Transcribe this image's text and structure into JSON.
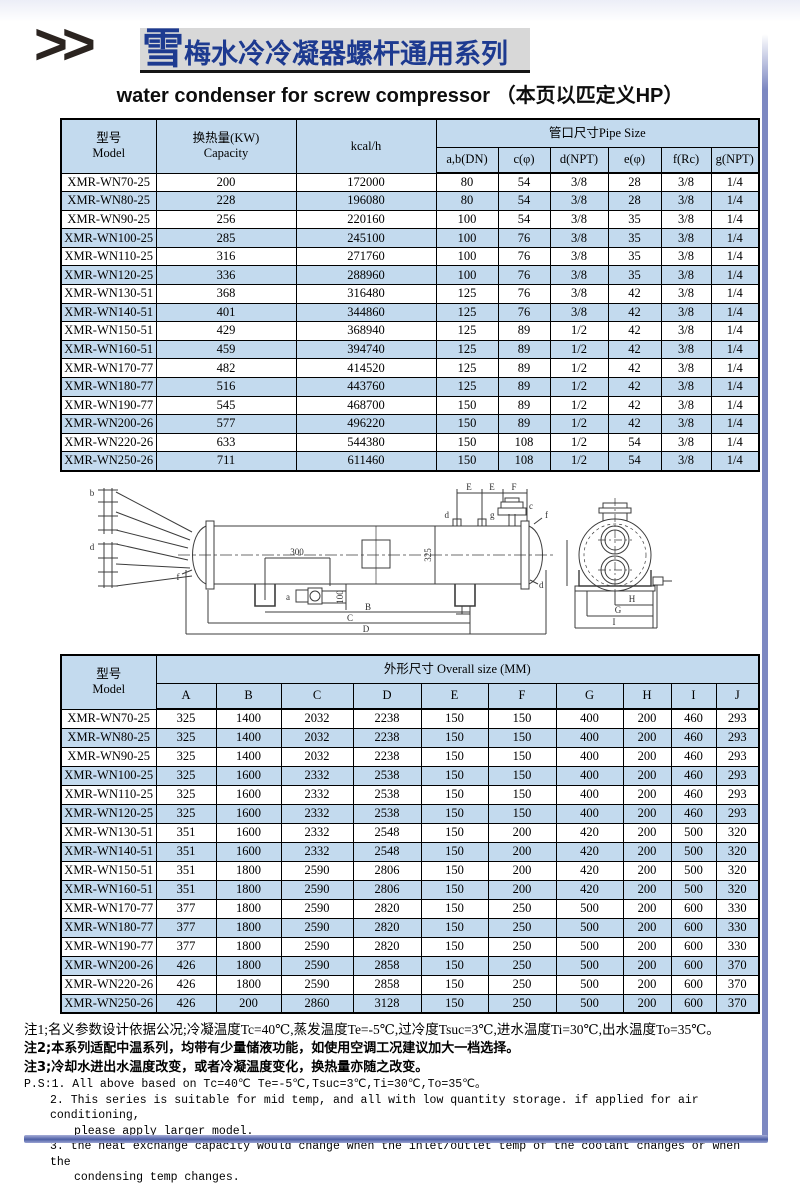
{
  "page": {
    "chevrons": ">>",
    "logo_char": "雪",
    "title_cn": "梅水冷冷凝器螺杆通用系列",
    "subtitle": "water condenser for screw compressor （本页以匹定义HP）"
  },
  "pipe_table": {
    "col_model": "型号",
    "col_model_en": "Model",
    "col_capacity": "换热量(KW)",
    "col_capacity_en": "Capacity",
    "col_kcal": "kcal/h",
    "col_pipe": "管口尺寸Pipe Size",
    "sub_cols": [
      "a,b(DN)",
      "c(φ)",
      "d(NPT)",
      "e(φ)",
      "f(Rc)",
      "g(NPT)"
    ],
    "rows": [
      [
        "XMR-WN70-25",
        "200",
        "172000",
        "80",
        "54",
        "3/8",
        "28",
        "3/8",
        "1/4"
      ],
      [
        "XMR-WN80-25",
        "228",
        "196080",
        "80",
        "54",
        "3/8",
        "28",
        "3/8",
        "1/4"
      ],
      [
        "XMR-WN90-25",
        "256",
        "220160",
        "100",
        "54",
        "3/8",
        "35",
        "3/8",
        "1/4"
      ],
      [
        "XMR-WN100-25",
        "285",
        "245100",
        "100",
        "76",
        "3/8",
        "35",
        "3/8",
        "1/4"
      ],
      [
        "XMR-WN110-25",
        "316",
        "271760",
        "100",
        "76",
        "3/8",
        "35",
        "3/8",
        "1/4"
      ],
      [
        "XMR-WN120-25",
        "336",
        "288960",
        "100",
        "76",
        "3/8",
        "35",
        "3/8",
        "1/4"
      ],
      [
        "XMR-WN130-51",
        "368",
        "316480",
        "125",
        "76",
        "3/8",
        "42",
        "3/8",
        "1/4"
      ],
      [
        "XMR-WN140-51",
        "401",
        "344860",
        "125",
        "76",
        "3/8",
        "42",
        "3/8",
        "1/4"
      ],
      [
        "XMR-WN150-51",
        "429",
        "368940",
        "125",
        "89",
        "1/2",
        "42",
        "3/8",
        "1/4"
      ],
      [
        "XMR-WN160-51",
        "459",
        "394740",
        "125",
        "89",
        "1/2",
        "42",
        "3/8",
        "1/4"
      ],
      [
        "XMR-WN170-77",
        "482",
        "414520",
        "125",
        "89",
        "1/2",
        "42",
        "3/8",
        "1/4"
      ],
      [
        "XMR-WN180-77",
        "516",
        "443760",
        "125",
        "89",
        "1/2",
        "42",
        "3/8",
        "1/4"
      ],
      [
        "XMR-WN190-77",
        "545",
        "468700",
        "150",
        "89",
        "1/2",
        "42",
        "3/8",
        "1/4"
      ],
      [
        "XMR-WN200-26",
        "577",
        "496220",
        "150",
        "89",
        "1/2",
        "42",
        "3/8",
        "1/4"
      ],
      [
        "XMR-WN220-26",
        "633",
        "544380",
        "150",
        "108",
        "1/2",
        "54",
        "3/8",
        "1/4"
      ],
      [
        "XMR-WN250-26",
        "711",
        "611460",
        "150",
        "108",
        "1/2",
        "54",
        "3/8",
        "1/4"
      ]
    ]
  },
  "drawing": {
    "labels": {
      "nozzle_b": "b",
      "nozzle_d_left": "d",
      "nozzle_f_left": "f",
      "valve_a": "a",
      "dim_300": "300",
      "dim_100": "100",
      "dim_325": "325",
      "dim_B": "B",
      "dim_C": "C",
      "dim_D": "D",
      "dim_E1": "E",
      "dim_E2": "E",
      "dim_F": "F",
      "nozzle_d_top": "d",
      "nozzle_g": "g",
      "valve_c": "c",
      "nozzle_f_right": "f",
      "nozzle_d_right": "d",
      "dim_H": "H",
      "dim_G": "G",
      "dim_I": "I"
    }
  },
  "size_table": {
    "col_model": "型号",
    "col_model_en": "Model",
    "col_overall": "外形尺寸 Overall size (MM)",
    "sub_cols": [
      "A",
      "B",
      "C",
      "D",
      "E",
      "F",
      "G",
      "H",
      "I",
      "J"
    ],
    "rows": [
      [
        "XMR-WN70-25",
        "325",
        "1400",
        "2032",
        "2238",
        "150",
        "150",
        "400",
        "200",
        "460",
        "293"
      ],
      [
        "XMR-WN80-25",
        "325",
        "1400",
        "2032",
        "2238",
        "150",
        "150",
        "400",
        "200",
        "460",
        "293"
      ],
      [
        "XMR-WN90-25",
        "325",
        "1400",
        "2032",
        "2238",
        "150",
        "150",
        "400",
        "200",
        "460",
        "293"
      ],
      [
        "XMR-WN100-25",
        "325",
        "1600",
        "2332",
        "2538",
        "150",
        "150",
        "400",
        "200",
        "460",
        "293"
      ],
      [
        "XMR-WN110-25",
        "325",
        "1600",
        "2332",
        "2538",
        "150",
        "150",
        "400",
        "200",
        "460",
        "293"
      ],
      [
        "XMR-WN120-25",
        "325",
        "1600",
        "2332",
        "2538",
        "150",
        "150",
        "400",
        "200",
        "460",
        "293"
      ],
      [
        "XMR-WN130-51",
        "351",
        "1600",
        "2332",
        "2548",
        "150",
        "200",
        "420",
        "200",
        "500",
        "320"
      ],
      [
        "XMR-WN140-51",
        "351",
        "1600",
        "2332",
        "2548",
        "150",
        "200",
        "420",
        "200",
        "500",
        "320"
      ],
      [
        "XMR-WN150-51",
        "351",
        "1800",
        "2590",
        "2806",
        "150",
        "200",
        "420",
        "200",
        "500",
        "320"
      ],
      [
        "XMR-WN160-51",
        "351",
        "1800",
        "2590",
        "2806",
        "150",
        "200",
        "420",
        "200",
        "500",
        "320"
      ],
      [
        "XMR-WN170-77",
        "377",
        "1800",
        "2590",
        "2820",
        "150",
        "250",
        "500",
        "200",
        "600",
        "330"
      ],
      [
        "XMR-WN180-77",
        "377",
        "1800",
        "2590",
        "2820",
        "150",
        "250",
        "500",
        "200",
        "600",
        "330"
      ],
      [
        "XMR-WN190-77",
        "377",
        "1800",
        "2590",
        "2820",
        "150",
        "250",
        "500",
        "200",
        "600",
        "330"
      ],
      [
        "XMR-WN200-26",
        "426",
        "1800",
        "2590",
        "2858",
        "150",
        "250",
        "500",
        "200",
        "600",
        "370"
      ],
      [
        "XMR-WN220-26",
        "426",
        "1800",
        "2590",
        "2858",
        "150",
        "250",
        "500",
        "200",
        "600",
        "370"
      ],
      [
        "XMR-WN250-26",
        "426",
        "200",
        "2860",
        "3128",
        "150",
        "250",
        "500",
        "200",
        "600",
        "370"
      ]
    ]
  },
  "notes": {
    "cn1": "注1;名义参数设计依据公况;冷凝温度Tc=40℃,蒸发温度Te=-5℃,过冷度Tsuc=3℃,进水温度Ti=30℃,出水温度To=35℃。",
    "cn2": "注2;本系列适配中温系列，均带有少量储液功能，如使用空调工况建议加大一档选择。",
    "cn3": "注3;冷却水进出水温度改变，或者冷凝温度变化，换热量亦随之改变。",
    "en1": "P.S:1.  All above based on Tc=40℃ Te=-5℃,Tsuc=3℃,Ti=30℃,To=35℃。",
    "en2a": "2.  This series is suitable for mid temp, and all with low quantity storage. if applied for air conditioning,",
    "en2b": "please apply larger model.",
    "en3a": "3.  the heat exchange capacity would change when the inlet/outlet temp of the coolant changes or when the",
    "en3b": "condensing temp changes."
  }
}
